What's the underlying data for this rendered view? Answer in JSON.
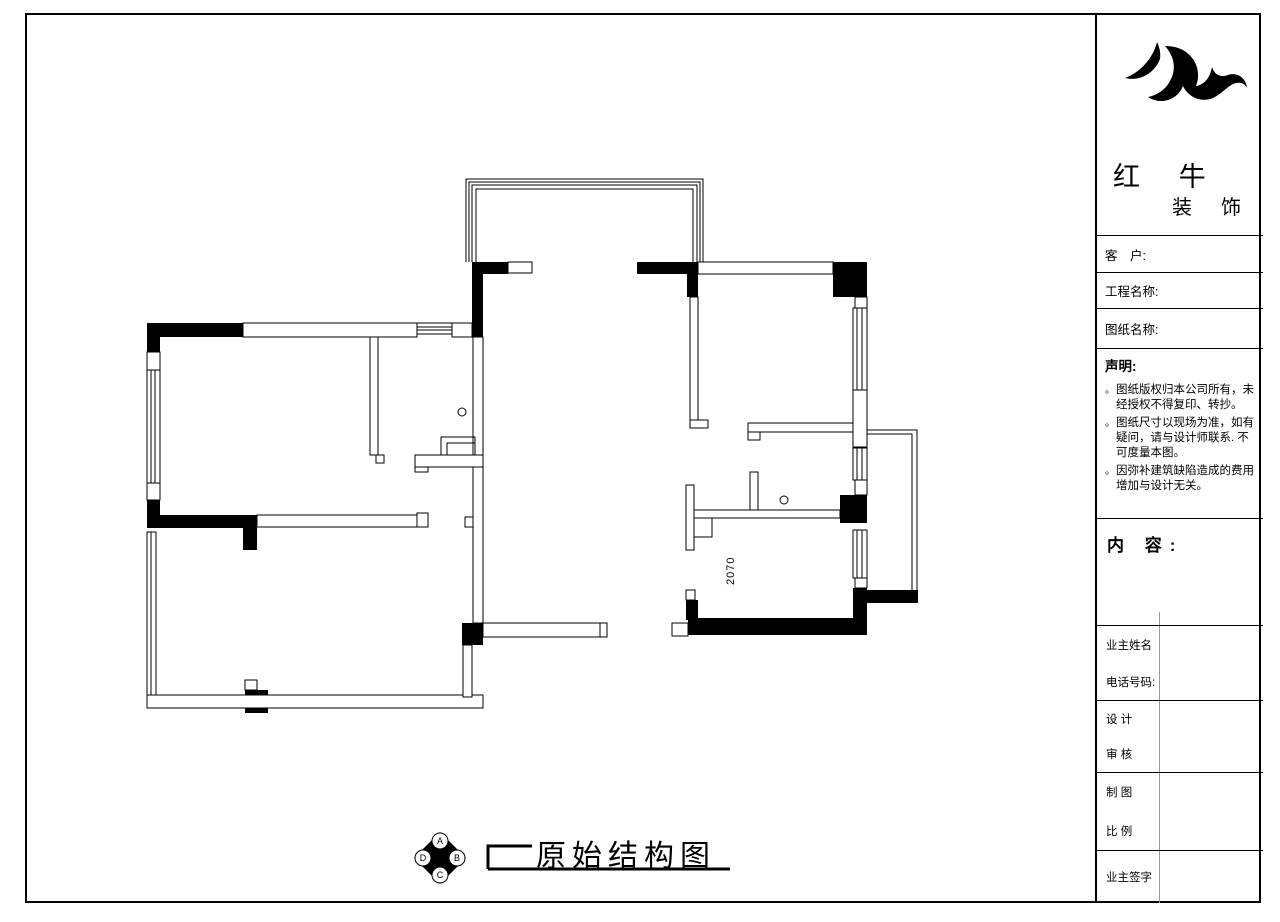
{
  "sheet": {
    "drawing_title": "原始结构图",
    "dimension_2070": "2070",
    "compass": {
      "top": "A",
      "right": "B",
      "bottom": "C",
      "left": "D"
    }
  },
  "title_block": {
    "company": {
      "name_main": "红 牛",
      "name_sub": "装 饰",
      "logo_icon": "bull-swoosh-logo"
    },
    "customer_label": "客　户:",
    "project_name_label": "工程名称:",
    "drawing_name_label": "图纸名称:",
    "statement": {
      "heading": "声明:",
      "bullet": "。",
      "items": [
        "图纸版权归本公司所有，未经授权不得复印、转抄。",
        "图纸尺寸以现场为准，如有疑问，请与设计师联系. 不可度量本图。",
        "因弥补建筑缺陷造成的费用增加与设计无关。"
      ]
    },
    "content_label": "内 容:",
    "owner_name_label": "业主姓名",
    "phone_label": "电话号码:",
    "design_label": "设 计",
    "review_label": "审 核",
    "draft_label": "制 图",
    "scale_label": "比 例",
    "owner_sign_label": "业主签字"
  }
}
